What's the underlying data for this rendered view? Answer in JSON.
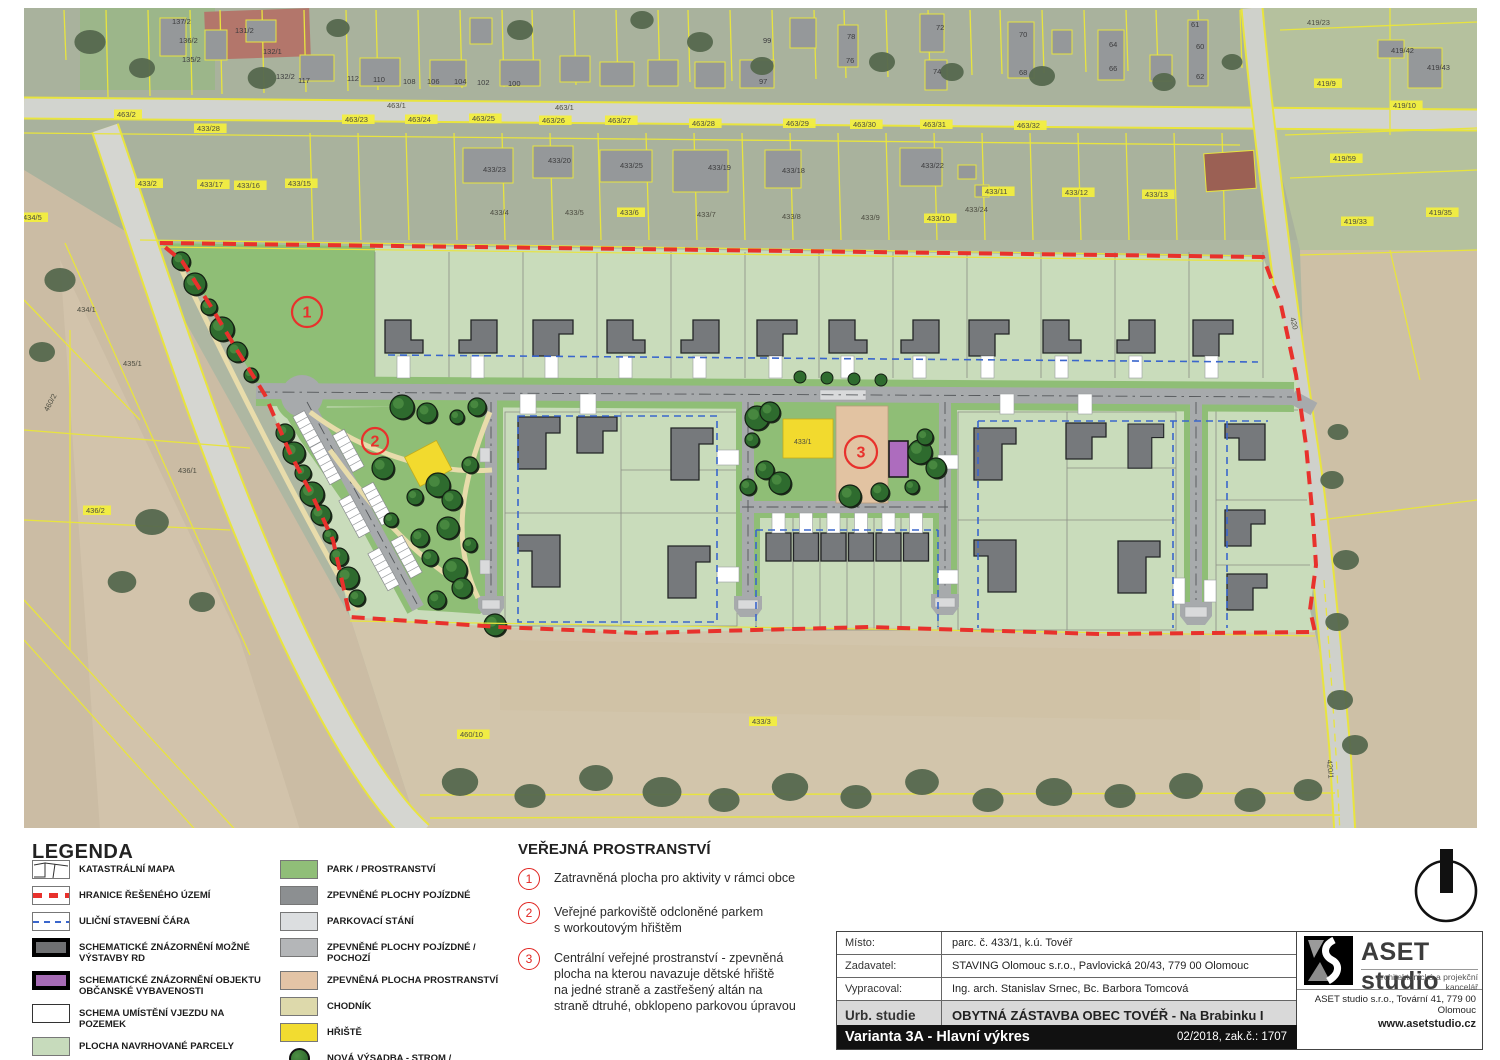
{
  "legend": {
    "title": "LEGENDA",
    "left": [
      {
        "label": "KATASTRÁLNÍ MAPA",
        "kind": "cad"
      },
      {
        "label": "HRANICE ŘEŠENÉHO ÚZEMÍ",
        "kind": "red"
      },
      {
        "label": "ULIČNÍ STAVEBNÍ ČÁRA",
        "kind": "blue"
      },
      {
        "label": "SCHEMATICKÉ ZNÁZORNĚNÍ MOŽNÉ VÝSTAVBY RD",
        "kind": "house"
      },
      {
        "label": "SCHEMATICKÉ ZNÁZORNĚNÍ OBJEKTU OBČANSKÉ VYBAVENOSTI",
        "kind": "civic"
      },
      {
        "label": "SCHEMA UMÍSTĚNÍ VJEZDU NA POZEMEK",
        "kind": "entry"
      },
      {
        "label": "PLOCHA NAVRHOVANÉ PARCELY",
        "kind": "color",
        "color": "#c7dbbc"
      }
    ],
    "right": [
      {
        "label": "PARK / PROSTRANSTVÍ",
        "kind": "color",
        "color": "#90be78"
      },
      {
        "label": "ZPEVNĚNÉ PLOCHY POJÍZDNÉ",
        "kind": "color",
        "color": "#8c8f91"
      },
      {
        "label": "PARKOVACÍ STÁNÍ",
        "kind": "color",
        "color": "#dcdee0"
      },
      {
        "label": "ZPEVNĚNÉ PLOCHY POJÍZDNÉ / POCHOZÍ",
        "kind": "color",
        "color": "#b4b6b8"
      },
      {
        "label": "ZPEVNĚNÁ PLOCHA PROSTRANSTVÍ",
        "kind": "color",
        "color": "#e3c4a6"
      },
      {
        "label": "CHODNÍK",
        "kind": "color",
        "color": "#ddd9ab"
      },
      {
        "label": "HŘIŠTĚ",
        "kind": "color",
        "color": "#f2dc30"
      },
      {
        "label": "NOVÁ VÝSADBA - STROM / STROMOŘADÍ",
        "kind": "tree"
      }
    ]
  },
  "notes": {
    "title": "VEŘEJNÁ PROSTRANSTVÍ",
    "items": [
      {
        "num": "1",
        "text": "Zatravněná plocha pro aktivity v rámci obce"
      },
      {
        "num": "2",
        "text": "Veřejné parkoviště odcloněné parkem\ns workoutovým hřištěm"
      },
      {
        "num": "3",
        "text": "Centrální veřejné prostranství - zpevněná\nplocha na kterou navazuje dětské hřiště\nna jedné straně a zastřešený altán na\nstraně dtruhé, obklopeno parkovou úpravou"
      }
    ]
  },
  "titleblock": {
    "rows": [
      {
        "label": "Místo:",
        "value": "parc. č. 433/1, k.ú. Tovéř"
      },
      {
        "label": "Zadavatel:",
        "value": "STAVING Olomouc s.r.o., Pavlovická 20/43, 779 00 Olomouc"
      },
      {
        "label": "Vypracoval:",
        "value": "Ing. arch. Stanislav Srnec, Bc. Barbora Tomcová"
      }
    ],
    "type_label": "Urb. studie",
    "type_value": "OBYTNÁ ZÁSTAVBA OBEC TOVÉŘ - Na Brabinku I",
    "variant": "Varianta 3A - Hlavní výkres",
    "date_job": "02/2018, zak.č.: 1707",
    "scale_label": "měřítko:",
    "scale_value": "1:1500",
    "sheet_label": "č.v.:",
    "sheet_value": "12"
  },
  "firm": {
    "name": "ASET studio",
    "tagline": "architektonická a projekční kancelář",
    "address": "ASET studio s.r.o., Tovární 41, 779 00 Olomouc",
    "web": "www.asetstudio.cz"
  },
  "map": {
    "markers": [
      {
        "num": "1",
        "x": 307,
        "y": 312,
        "r": 15
      },
      {
        "num": "2",
        "x": 375,
        "y": 441,
        "r": 13
      },
      {
        "num": "3",
        "x": 861,
        "y": 452,
        "r": 16
      }
    ],
    "labels": [
      {
        "t": "137/2",
        "x": 172,
        "y": 24,
        "k": "b"
      },
      {
        "t": "136/2",
        "x": 179,
        "y": 43,
        "k": "b"
      },
      {
        "t": "135/2",
        "x": 182,
        "y": 62,
        "k": "b"
      },
      {
        "t": "131/2",
        "x": 235,
        "y": 33,
        "k": "b"
      },
      {
        "t": "132/1",
        "x": 263,
        "y": 54,
        "k": "b"
      },
      {
        "t": "132/2",
        "x": 276,
        "y": 79,
        "k": "b"
      },
      {
        "t": "117",
        "x": 298,
        "y": 83,
        "k": "b"
      },
      {
        "t": "112",
        "x": 347,
        "y": 81,
        "k": "b"
      },
      {
        "t": "110",
        "x": 373,
        "y": 82,
        "k": "b"
      },
      {
        "t": "108",
        "x": 403,
        "y": 84,
        "k": "b"
      },
      {
        "t": "106",
        "x": 427,
        "y": 84,
        "k": "b"
      },
      {
        "t": "104",
        "x": 454,
        "y": 84,
        "k": "b"
      },
      {
        "t": "102",
        "x": 477,
        "y": 85,
        "k": "b"
      },
      {
        "t": "100",
        "x": 508,
        "y": 86,
        "k": "b"
      },
      {
        "t": "99",
        "x": 763,
        "y": 43,
        "k": "b"
      },
      {
        "t": "97",
        "x": 759,
        "y": 84,
        "k": "b"
      },
      {
        "t": "78",
        "x": 847,
        "y": 39,
        "k": "b"
      },
      {
        "t": "76",
        "x": 846,
        "y": 63,
        "k": "b"
      },
      {
        "t": "72",
        "x": 936,
        "y": 30,
        "k": "b"
      },
      {
        "t": "74",
        "x": 933,
        "y": 74,
        "k": "b"
      },
      {
        "t": "70",
        "x": 1019,
        "y": 37,
        "k": "b"
      },
      {
        "t": "68",
        "x": 1019,
        "y": 75,
        "k": "b"
      },
      {
        "t": "64",
        "x": 1109,
        "y": 47,
        "k": "b"
      },
      {
        "t": "66",
        "x": 1109,
        "y": 71,
        "k": "b"
      },
      {
        "t": "61",
        "x": 1191,
        "y": 27,
        "k": "b"
      },
      {
        "t": "60",
        "x": 1196,
        "y": 49,
        "k": "b"
      },
      {
        "t": "62",
        "x": 1196,
        "y": 79,
        "k": "b"
      },
      {
        "t": "463/1",
        "x": 387,
        "y": 108,
        "k": "p"
      },
      {
        "t": "463/1",
        "x": 555,
        "y": 110,
        "k": "p"
      },
      {
        "t": "463/2",
        "x": 117,
        "y": 117,
        "k": "c"
      },
      {
        "t": "433/28",
        "x": 197,
        "y": 131,
        "k": "c"
      },
      {
        "t": "463/23",
        "x": 345,
        "y": 122,
        "k": "c"
      },
      {
        "t": "463/24",
        "x": 408,
        "y": 122,
        "k": "c"
      },
      {
        "t": "463/25",
        "x": 472,
        "y": 121,
        "k": "c"
      },
      {
        "t": "463/26",
        "x": 542,
        "y": 123,
        "k": "c"
      },
      {
        "t": "463/27",
        "x": 608,
        "y": 123,
        "k": "c"
      },
      {
        "t": "463/28",
        "x": 692,
        "y": 126,
        "k": "c"
      },
      {
        "t": "463/29",
        "x": 786,
        "y": 126,
        "k": "c"
      },
      {
        "t": "463/30",
        "x": 853,
        "y": 127,
        "k": "c"
      },
      {
        "t": "463/31",
        "x": 923,
        "y": 127,
        "k": "c"
      },
      {
        "t": "463/32",
        "x": 1017,
        "y": 128,
        "k": "c"
      },
      {
        "t": "433/2",
        "x": 138,
        "y": 186,
        "k": "c"
      },
      {
        "t": "433/17",
        "x": 200,
        "y": 187,
        "k": "c"
      },
      {
        "t": "433/16",
        "x": 237,
        "y": 188,
        "k": "c"
      },
      {
        "t": "433/15",
        "x": 288,
        "y": 186,
        "k": "c"
      },
      {
        "t": "433/23",
        "x": 483,
        "y": 172,
        "k": "b"
      },
      {
        "t": "433/20",
        "x": 548,
        "y": 163,
        "k": "b"
      },
      {
        "t": "433/25",
        "x": 620,
        "y": 168,
        "k": "b"
      },
      {
        "t": "433/19",
        "x": 708,
        "y": 170,
        "k": "b"
      },
      {
        "t": "433/18",
        "x": 782,
        "y": 173,
        "k": "b"
      },
      {
        "t": "433/22",
        "x": 921,
        "y": 168,
        "k": "b"
      },
      {
        "t": "433/4",
        "x": 490,
        "y": 215,
        "k": "p"
      },
      {
        "t": "433/5",
        "x": 565,
        "y": 215,
        "k": "p"
      },
      {
        "t": "433/6",
        "x": 620,
        "y": 215,
        "k": "c"
      },
      {
        "t": "433/7",
        "x": 697,
        "y": 217,
        "k": "p"
      },
      {
        "t": "433/8",
        "x": 782,
        "y": 219,
        "k": "p"
      },
      {
        "t": "433/9",
        "x": 861,
        "y": 220,
        "k": "p"
      },
      {
        "t": "433/10",
        "x": 927,
        "y": 221,
        "k": "c"
      },
      {
        "t": "433/24",
        "x": 965,
        "y": 212,
        "k": "p"
      },
      {
        "t": "433/11",
        "x": 985,
        "y": 194,
        "k": "c"
      },
      {
        "t": "433/12",
        "x": 1065,
        "y": 195,
        "k": "c"
      },
      {
        "t": "433/13",
        "x": 1145,
        "y": 197,
        "k": "c"
      },
      {
        "t": "419/23",
        "x": 1307,
        "y": 25,
        "k": "p"
      },
      {
        "t": "419/42",
        "x": 1391,
        "y": 53,
        "k": "b"
      },
      {
        "t": "419/43",
        "x": 1427,
        "y": 70,
        "k": "b"
      },
      {
        "t": "419/9",
        "x": 1317,
        "y": 86,
        "k": "c"
      },
      {
        "t": "419/10",
        "x": 1393,
        "y": 108,
        "k": "c"
      },
      {
        "t": "419/59",
        "x": 1333,
        "y": 161,
        "k": "c"
      },
      {
        "t": "419/33",
        "x": 1344,
        "y": 224,
        "k": "c"
      },
      {
        "t": "419/35",
        "x": 1429,
        "y": 215,
        "k": "c"
      },
      {
        "t": "434/5",
        "x": 23,
        "y": 220,
        "k": "c"
      },
      {
        "t": "434/1",
        "x": 77,
        "y": 312,
        "k": "p"
      },
      {
        "t": "435/1",
        "x": 123,
        "y": 366,
        "k": "p"
      },
      {
        "t": "436/1",
        "x": 178,
        "y": 473,
        "k": "p"
      },
      {
        "t": "436/2",
        "x": 86,
        "y": 513,
        "k": "c"
      },
      {
        "t": "460/10",
        "x": 460,
        "y": 737,
        "k": "c"
      },
      {
        "t": "433/3",
        "x": 752,
        "y": 724,
        "k": "c"
      },
      {
        "t": "433/1",
        "x": 794,
        "y": 444,
        "k": "plan"
      },
      {
        "t": "420",
        "x": 1290,
        "y": 318,
        "k": "p",
        "rot": 75
      },
      {
        "t": "460/2",
        "x": 48,
        "y": 412,
        "k": "p",
        "rot": -62
      },
      {
        "t": "420/1",
        "x": 1327,
        "y": 760,
        "k": "p",
        "rot": 85
      }
    ]
  }
}
